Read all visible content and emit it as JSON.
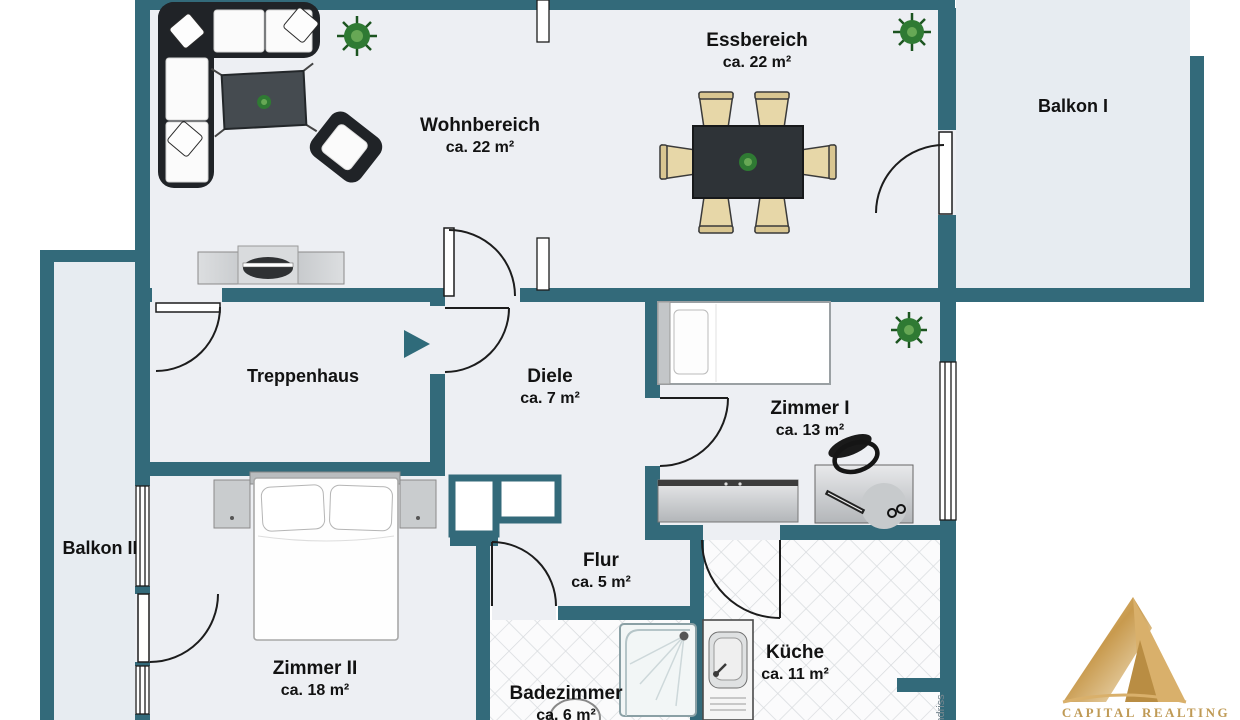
{
  "plan": {
    "rooms": [
      {
        "id": "wohnbereich",
        "name": "Wohnbereich",
        "area": "ca. 22 m²"
      },
      {
        "id": "essbereich",
        "name": "Essbereich",
        "area": "ca. 22 m²"
      },
      {
        "id": "balkon1",
        "name": "Balkon I",
        "area": ""
      },
      {
        "id": "treppenhaus",
        "name": "Treppenhaus",
        "area": ""
      },
      {
        "id": "diele",
        "name": "Diele",
        "area": "ca. 7 m²"
      },
      {
        "id": "zimmer1",
        "name": "Zimmer I",
        "area": "ca. 13 m²"
      },
      {
        "id": "balkon2",
        "name": "Balkon II",
        "area": ""
      },
      {
        "id": "zimmer2",
        "name": "Zimmer II",
        "area": "ca. 18 m²"
      },
      {
        "id": "flur",
        "name": "Flur",
        "area": "ca. 5 m²"
      },
      {
        "id": "badezimmer",
        "name": "Badezimmer",
        "area": "ca. 6 m²"
      },
      {
        "id": "kueche",
        "name": "Küche",
        "area": "ca. 11 m²"
      }
    ],
    "side_label": "Grundriss",
    "watermark": {
      "brand": "CAPITAL REALTING"
    },
    "colors": {
      "wall": "#336a7a",
      "floor": "#edeff3",
      "balcony_floor": "#e7ecf1",
      "gold": "#c89a4e",
      "label": "#121212"
    }
  }
}
